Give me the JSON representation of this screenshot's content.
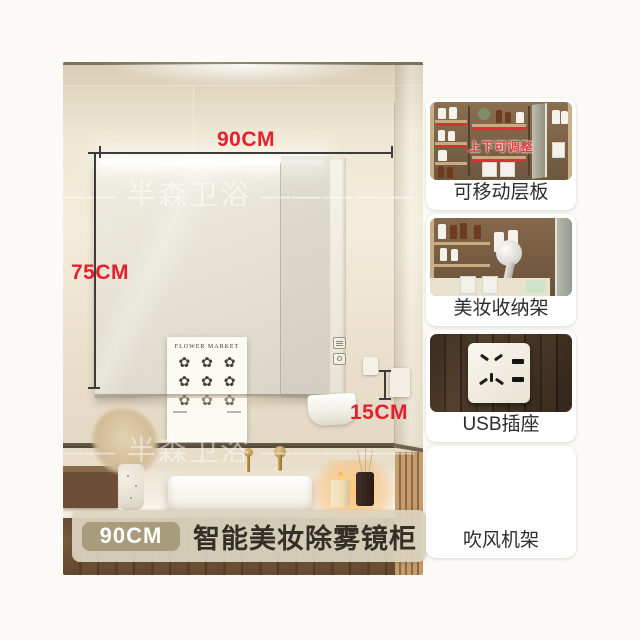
{
  "photo": {
    "watermark_text": "—— 半森卫浴 ————— 半森卫浴",
    "dim_width": "90CM",
    "dim_height": "75CM",
    "dim_depth": "15CM",
    "poster_title": "FLOWER MARKET",
    "flower_glyph": "✿"
  },
  "footer": {
    "badge": "90CM",
    "title": "智能美妆除雾镜柜"
  },
  "features": [
    {
      "label": "可移动层板",
      "note": "上下可调整"
    },
    {
      "label": "美妆收纳架"
    },
    {
      "label": "USB插座"
    },
    {
      "label": "吹风机架"
    }
  ],
  "colors": {
    "dimension_red": "#e5202e",
    "badge_bg": "#a79c7c",
    "footer_bar_bg": "#dbd4c0",
    "note_red": "#e03a3a"
  }
}
